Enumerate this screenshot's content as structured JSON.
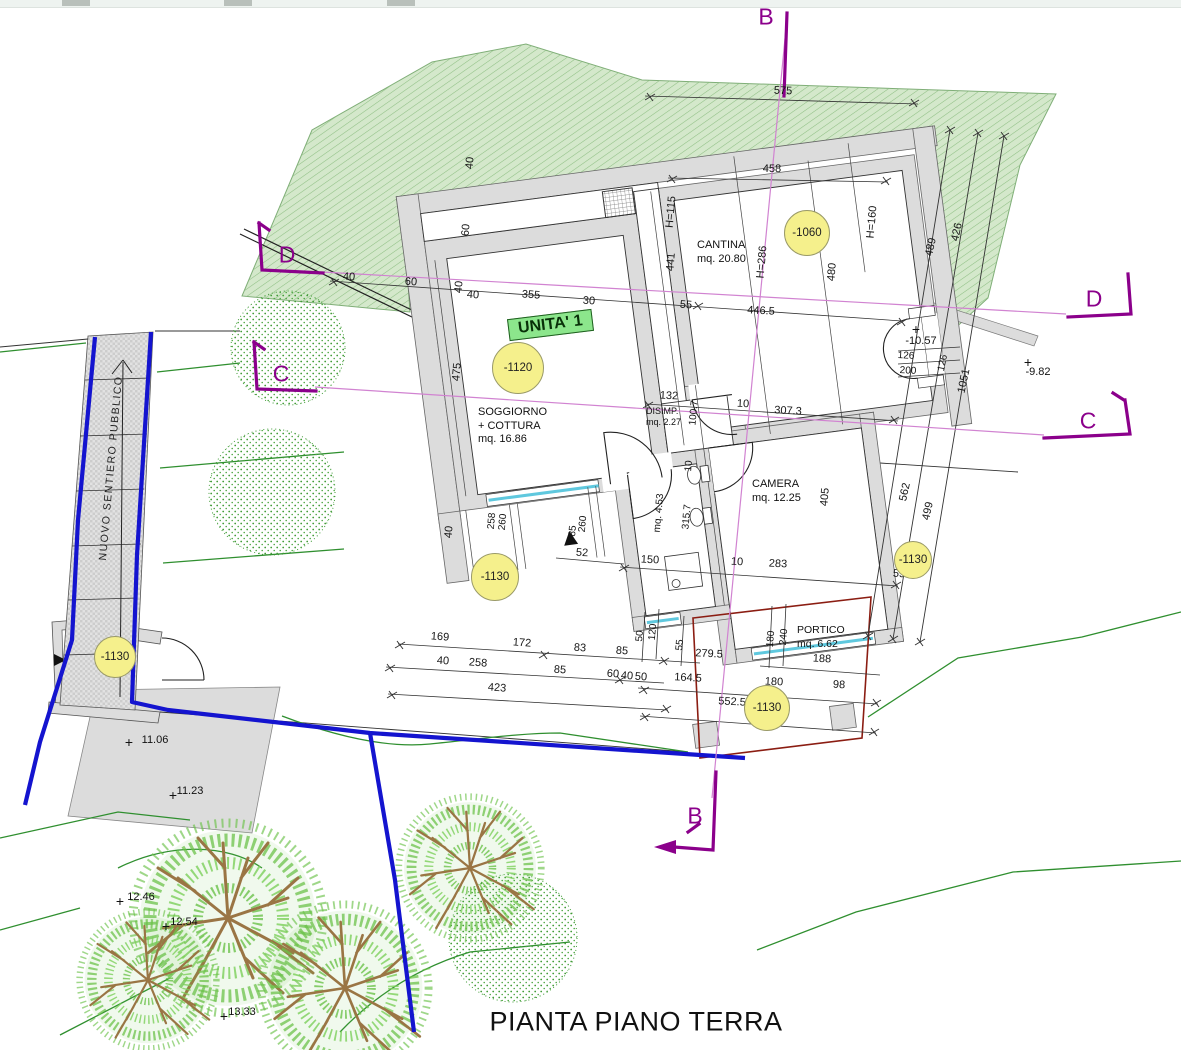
{
  "title": {
    "text": "PIANTA PIANO TERRA"
  },
  "unit_label": {
    "text": "UNITA' 1"
  },
  "path_label": {
    "text": "NUOVO SENTIERO PUBBLICO",
    "x": 111,
    "y": 468
  },
  "rooms": [
    {
      "lines": [
        "CANTINA",
        "mq. 20.80"
      ],
      "x": 697,
      "y": 239
    },
    {
      "lines": [
        "SOGGIORNO",
        "+ COTTURA",
        "mq. 16.86"
      ],
      "x": 478,
      "y": 406
    },
    {
      "lines": [
        "DISIMP.",
        "mq. 2.27"
      ],
      "x": 646,
      "y": 406,
      "fs": 9,
      "lh": 11
    },
    {
      "lines": [
        "CAMERA",
        "mq. 12.25"
      ],
      "x": 752,
      "y": 478
    },
    {
      "lines": [
        "PORTICO",
        "mq. 6.62"
      ],
      "x": 797,
      "y": 624,
      "fs": 10.5
    }
  ],
  "elevation_markers": [
    {
      "label": "-1060",
      "x": 807,
      "y": 233,
      "r": 22
    },
    {
      "label": "-1120",
      "x": 518,
      "y": 368,
      "r": 25
    },
    {
      "label": "-1130",
      "x": 495,
      "y": 577,
      "r": 23
    },
    {
      "label": "-1130",
      "x": 115,
      "y": 657,
      "r": 20
    },
    {
      "label": "-1130",
      "x": 913,
      "y": 560,
      "r": 18
    },
    {
      "label": "-1130",
      "x": 767,
      "y": 708,
      "r": 22
    }
  ],
  "section_markers": [
    {
      "label": "B",
      "x": 766,
      "y": 17
    },
    {
      "label": "B",
      "x": 695,
      "y": 816
    },
    {
      "label": "C",
      "x": 1088,
      "y": 421
    },
    {
      "label": "C",
      "x": 281,
      "y": 374
    },
    {
      "label": "D",
      "x": 287,
      "y": 255
    },
    {
      "label": "D",
      "x": 1094,
      "y": 299
    }
  ],
  "spot_elevations": [
    {
      "label": "-10.57",
      "x": 921,
      "y": 341,
      "cx": 916,
      "cy": 329
    },
    {
      "label": "-9.82",
      "x": 1038,
      "y": 372,
      "cx": 1028,
      "cy": 362
    },
    {
      "label": "11.06",
      "x": 155,
      "y": 740,
      "cx": 129,
      "cy": 742
    },
    {
      "label": "11.23",
      "x": 190,
      "y": 791,
      "cx": 173,
      "cy": 795
    },
    {
      "label": "12.46",
      "x": 141,
      "y": 897,
      "cx": 120,
      "cy": 901
    },
    {
      "label": "12.54",
      "x": 184,
      "y": 922,
      "cx": 166,
      "cy": 926
    },
    {
      "label": "13.33",
      "x": 242,
      "y": 1012,
      "cx": 224,
      "cy": 1016
    }
  ],
  "dimensions": [
    {
      "t": "575",
      "x": 783,
      "y": 91,
      "r": 2
    },
    {
      "t": "458",
      "x": 772,
      "y": 169,
      "r": 1
    },
    {
      "t": "40",
      "x": 470,
      "y": 163,
      "r": -85
    },
    {
      "t": "60",
      "x": 466,
      "y": 230,
      "r": -85
    },
    {
      "t": "H=115",
      "x": 671,
      "y": 212,
      "r": -85
    },
    {
      "t": "441",
      "x": 671,
      "y": 262,
      "r": -85
    },
    {
      "t": "H=286",
      "x": 762,
      "y": 262,
      "r": -85
    },
    {
      "t": "480",
      "x": 832,
      "y": 272,
      "r": -85
    },
    {
      "t": "H=160",
      "x": 872,
      "y": 222,
      "r": -85
    },
    {
      "t": "489",
      "x": 931,
      "y": 247,
      "r": -78
    },
    {
      "t": "426",
      "x": 957,
      "y": 232,
      "r": -78
    },
    {
      "t": "40",
      "x": 349,
      "y": 277,
      "r": 4
    },
    {
      "t": "60",
      "x": 411,
      "y": 282,
      "r": 4
    },
    {
      "t": "40",
      "x": 459,
      "y": 287,
      "r": -85
    },
    {
      "t": "40",
      "x": 473,
      "y": 295,
      "r": 4
    },
    {
      "t": "355",
      "x": 531,
      "y": 295,
      "r": 4
    },
    {
      "t": "30",
      "x": 589,
      "y": 301,
      "r": 4
    },
    {
      "t": "55",
      "x": 686,
      "y": 305,
      "r": 4
    },
    {
      "t": "446.5",
      "x": 761,
      "y": 311,
      "r": 3
    },
    {
      "t": "126",
      "x": 906,
      "y": 356,
      "r": 3,
      "fs": 10
    },
    {
      "t": "200",
      "x": 908,
      "y": 371,
      "r": 3,
      "fs": 10
    },
    {
      "t": "126",
      "x": 943,
      "y": 363,
      "r": -78,
      "fs": 10
    },
    {
      "t": "1051",
      "x": 964,
      "y": 381,
      "r": -78
    },
    {
      "t": "475",
      "x": 457,
      "y": 372,
      "r": -85
    },
    {
      "t": "132",
      "x": 669,
      "y": 396,
      "r": 3
    },
    {
      "t": "100.7",
      "x": 694,
      "y": 413,
      "r": -85,
      "fs": 10
    },
    {
      "t": "10",
      "x": 743,
      "y": 404,
      "r": 3
    },
    {
      "t": "307.3",
      "x": 788,
      "y": 411,
      "r": 3
    },
    {
      "t": "10",
      "x": 689,
      "y": 466,
      "r": -85,
      "fs": 10
    },
    {
      "t": "mq. 4.53",
      "x": 659,
      "y": 513,
      "r": -85,
      "fs": 10
    },
    {
      "t": "315.7",
      "x": 687,
      "y": 517,
      "r": -85,
      "fs": 10
    },
    {
      "t": "405",
      "x": 825,
      "y": 497,
      "r": -85
    },
    {
      "t": "562",
      "x": 905,
      "y": 492,
      "r": -78
    },
    {
      "t": "499",
      "x": 928,
      "y": 511,
      "r": -78
    },
    {
      "t": "40",
      "x": 449,
      "y": 532,
      "r": -85
    },
    {
      "t": "258",
      "x": 492,
      "y": 521,
      "r": -85,
      "fs": 10
    },
    {
      "t": "260",
      "x": 503,
      "y": 522,
      "r": -85,
      "fs": 10
    },
    {
      "t": "85",
      "x": 573,
      "y": 531,
      "r": -85,
      "fs": 10
    },
    {
      "t": "260",
      "x": 583,
      "y": 524,
      "r": -85,
      "fs": 10
    },
    {
      "t": "52",
      "x": 582,
      "y": 553,
      "r": 3
    },
    {
      "t": "150",
      "x": 650,
      "y": 560,
      "r": 3
    },
    {
      "t": "10",
      "x": 737,
      "y": 562,
      "r": 3
    },
    {
      "t": "283",
      "x": 778,
      "y": 564,
      "r": 3
    },
    {
      "t": "55",
      "x": 899,
      "y": 574,
      "r": 3
    },
    {
      "t": "50",
      "x": 640,
      "y": 636,
      "r": -85,
      "fs": 10
    },
    {
      "t": "120",
      "x": 653,
      "y": 632,
      "r": -85,
      "fs": 10
    },
    {
      "t": "55",
      "x": 680,
      "y": 645,
      "r": -85,
      "fs": 10
    },
    {
      "t": "180",
      "x": 771,
      "y": 639,
      "r": -85,
      "fs": 10
    },
    {
      "t": "240",
      "x": 784,
      "y": 637,
      "r": -85,
      "fs": 10
    },
    {
      "t": "279.5",
      "x": 709,
      "y": 654,
      "r": 3
    },
    {
      "t": "188",
      "x": 822,
      "y": 659,
      "r": 3
    },
    {
      "t": "169",
      "x": 440,
      "y": 637,
      "r": 4
    },
    {
      "t": "172",
      "x": 522,
      "y": 643,
      "r": 4
    },
    {
      "t": "83",
      "x": 580,
      "y": 648,
      "r": 4
    },
    {
      "t": "85",
      "x": 622,
      "y": 651,
      "r": 4
    },
    {
      "t": "40",
      "x": 443,
      "y": 661,
      "r": 4
    },
    {
      "t": "258",
      "x": 478,
      "y": 663,
      "r": 4
    },
    {
      "t": "85",
      "x": 560,
      "y": 670,
      "r": 4
    },
    {
      "t": "60",
      "x": 613,
      "y": 674,
      "r": 4
    },
    {
      "t": "40",
      "x": 627,
      "y": 676,
      "r": 4
    },
    {
      "t": "50",
      "x": 641,
      "y": 677,
      "r": 4
    },
    {
      "t": "423",
      "x": 497,
      "y": 688,
      "r": 4
    },
    {
      "t": "164.5",
      "x": 688,
      "y": 678,
      "r": 3
    },
    {
      "t": "180",
      "x": 774,
      "y": 682,
      "r": 3
    },
    {
      "t": "98",
      "x": 839,
      "y": 685,
      "r": 3
    },
    {
      "t": "552.5",
      "x": 732,
      "y": 702,
      "r": 3
    }
  ],
  "colors": {
    "terrain_green": "#d4e8cb",
    "hatch_green": "#8fbf84",
    "wall_gray": "#dcdcdc",
    "marker_yellow": "#f5f08c",
    "section_purple": "#8B008B",
    "section_line_pink": "#d183d1",
    "boundary_blue": "#1414cf",
    "portico_red": "#8b1d12",
    "contour_green": "#2f8f2f",
    "tree_green": "#3f9b35",
    "branch_brown": "#9a7544",
    "window_cyan": "#5fc8de",
    "unit_label_green": "#8ce68c"
  }
}
